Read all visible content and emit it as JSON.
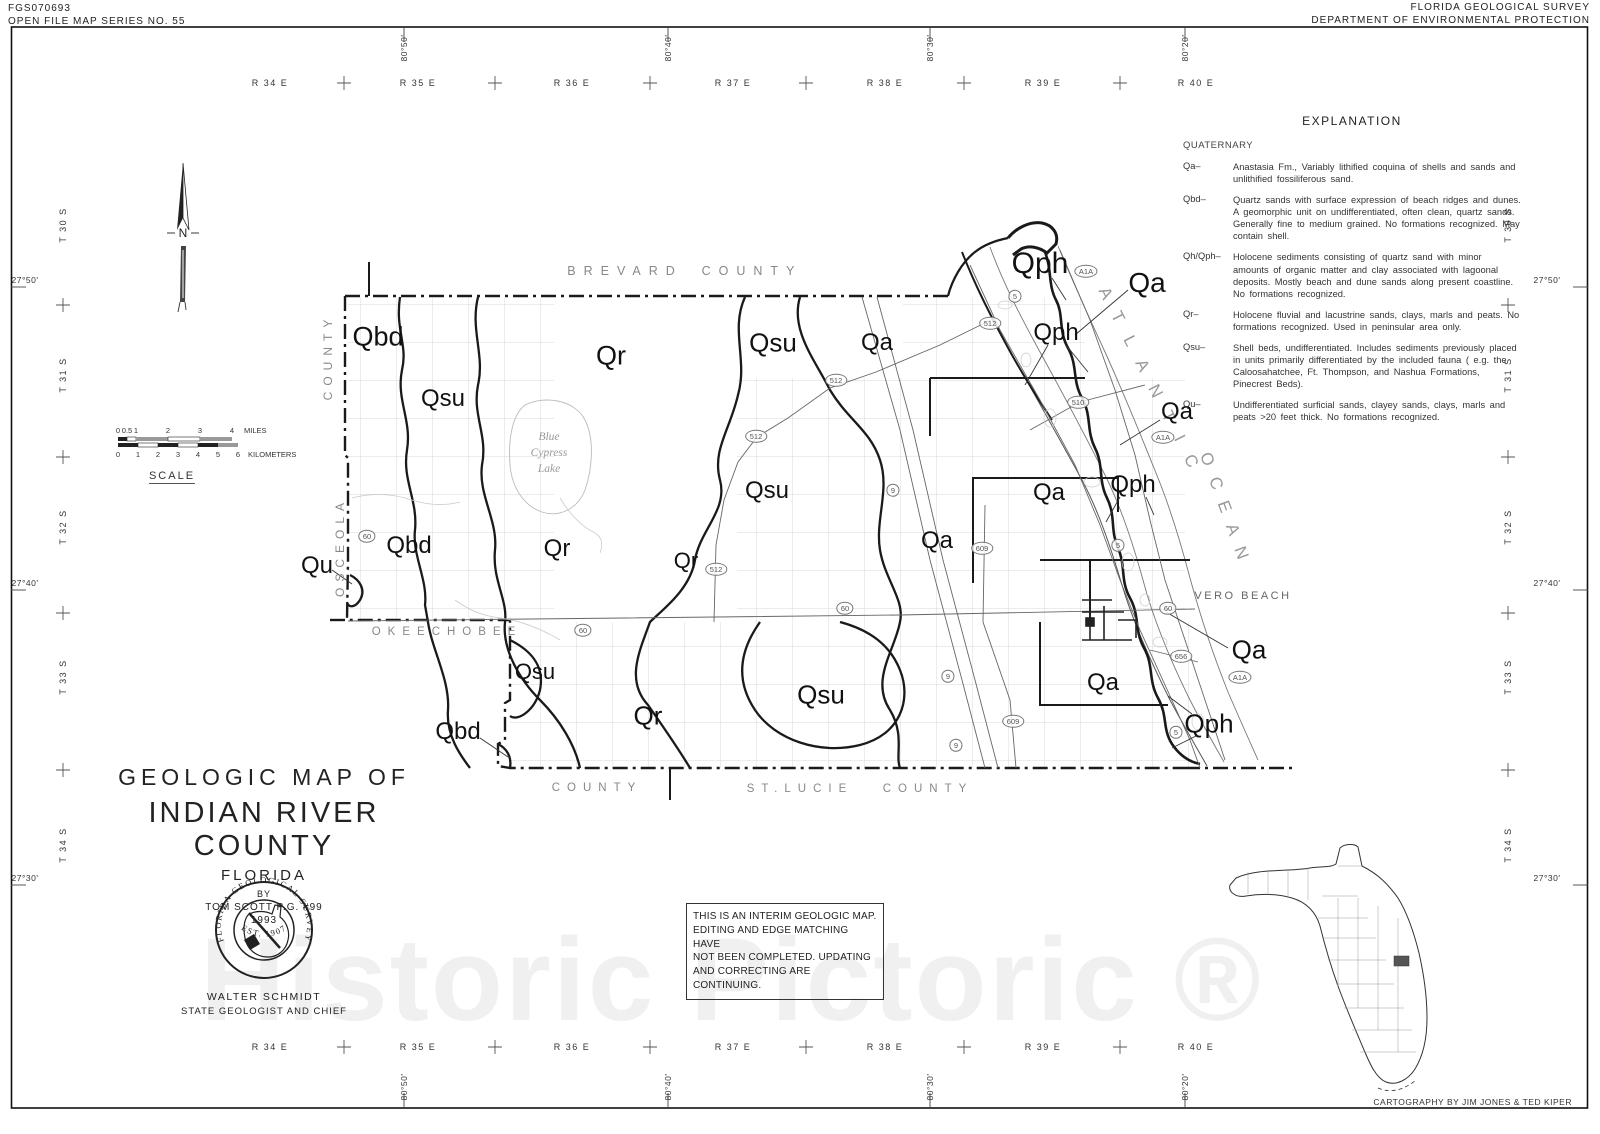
{
  "sheet": {
    "doc_id": "FGS070693",
    "series": "OPEN FILE MAP SERIES NO. 55",
    "agency1": "FLORIDA GEOLOGICAL SURVEY",
    "agency2": "DEPARTMENT OF ENVIRONMENTAL PROTECTION",
    "credit": "CARTOGRAPHY BY JIM JONES & TED KIPER",
    "watermark": "Historic Pictoric ®"
  },
  "explanation": {
    "title": "EXPLANATION",
    "era": "QUATERNARY",
    "entries": [
      {
        "code": "Qa–",
        "text": "Anastasia Fm., Variably lithified coquina of shells and sands and unlithified fossiliferous sand."
      },
      {
        "code": "Qbd–",
        "text": "Quartz sands with surface expression of beach ridges and dunes. A geomorphic unit on undifferentiated, often clean, quartz sands.  Generally fine to medium grained.  No formations recognized.  May contain shell."
      },
      {
        "code": "Qh/Qph–",
        "text": "Holocene sediments consisting of quartz sand with minor amounts of organic matter and clay associated with lagoonal deposits. Mostly beach and dune sands along present coastline. No formations recognized."
      },
      {
        "code": "Qr–",
        "text": "Holocene fluvial and lacustrine sands, clays, marls and peats.  No formations recognized.  Used in peninsular area only."
      },
      {
        "code": "Qsu–",
        "text": "Shell beds, undifferentiated.  Includes sediments previously placed in units primarily differentiated by the included fauna ( e.g. the Caloosahatchee, Ft. Thompson, and Nashua Formations, Pinecrest Beds)."
      },
      {
        "code": "Qu–",
        "text": "Undifferentiated surficial sands, clayey sands, clays, marls and peats >20 feet thick.  No formations recognized."
      }
    ]
  },
  "title_block": {
    "line1": "GEOLOGIC MAP OF",
    "line2": "INDIAN RIVER COUNTY",
    "line3": "FLORIDA",
    "by": "BY",
    "author": "TOM SCOTT P.G. #99",
    "year": "1993",
    "seal_top": "FLORIDA GEOLOGICAL SURVEY",
    "seal_bottom": "EST.      1907",
    "chief": "WALTER SCHMIDT",
    "chief_title": "STATE GEOLOGIST AND CHIEF"
  },
  "note": {
    "l1": "THIS IS AN INTERIM GEOLOGIC MAP.",
    "l2": "EDITING AND EDGE MATCHING HAVE",
    "l3": "NOT BEEN COMPLETED.  UPDATING",
    "l4": "AND CORRECTING ARE CONTINUING."
  },
  "scalebar": {
    "miles": [
      "0",
      "0.5",
      "1",
      "2",
      "3",
      "4"
    ],
    "miles_unit": "MILES",
    "km": [
      "0",
      "1",
      "2",
      "3",
      "4",
      "5",
      "6"
    ],
    "km_unit": "KILOMETERS",
    "caption": "SCALE"
  },
  "compass": {
    "n": "N"
  },
  "grid": {
    "ranges": [
      "R 34 E",
      "R 35 E",
      "R 36 E",
      "R 37 E",
      "R 38 E",
      "R 39 E",
      "R 40 E"
    ],
    "townships": [
      "T 30 S",
      "T 31 S",
      "T 32 S",
      "T 33 S",
      "T 34 S"
    ],
    "longitudes": [
      "80°50'",
      "80°40'",
      "80°30'",
      "80°20'"
    ],
    "latitudes": [
      "27°50'",
      "27°40'",
      "27°30'"
    ]
  },
  "map": {
    "counties": {
      "brevard": [
        "BREVARD",
        "COUNTY"
      ],
      "osceola": [
        "OSCEOLA",
        "COUNTY"
      ],
      "okeechobee": [
        "OKEECHOBEE",
        "COUNTY"
      ],
      "stlucie": [
        "ST.LUCIE",
        "COUNTY"
      ]
    },
    "ocean": [
      "ATLANTIC",
      "OCEAN"
    ],
    "lake": [
      "Blue",
      "Cypress",
      "Lake"
    ],
    "city": "VERO BEACH",
    "units": [
      "Qbd",
      "Qsu",
      "Qr",
      "Qsu",
      "Qa",
      "Qph",
      "Qa",
      "Qph",
      "Qa",
      "Qph",
      "Qa",
      "Qsu",
      "Qa",
      "Qbd",
      "Qu",
      "Qr",
      "Qr",
      "Qsu",
      "Qa",
      "Qa",
      "Qsu",
      "Qr",
      "Qph",
      "Qbd"
    ],
    "shields": [
      "5",
      "512",
      "A1A",
      "512",
      "510",
      "A1A",
      "512",
      "9",
      "60",
      "512",
      "5",
      "609",
      "60",
      "60",
      "60",
      "656",
      "A1A",
      "9",
      "609",
      "5",
      "9"
    ]
  }
}
